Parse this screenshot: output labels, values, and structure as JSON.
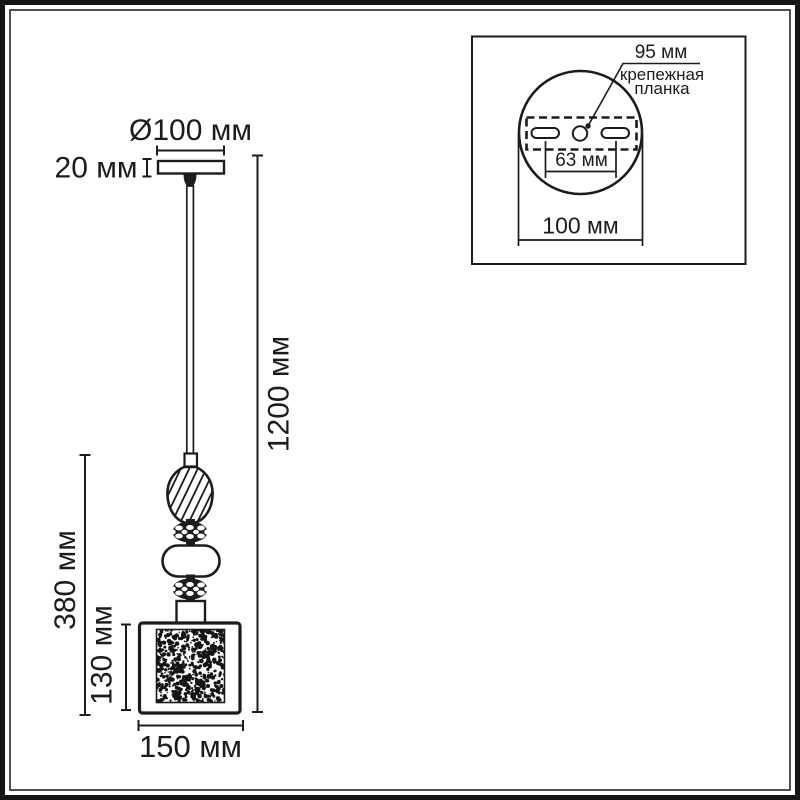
{
  "colors": {
    "line": "#1c1c1c",
    "background": "#ffffff",
    "border_outer": "#151515",
    "border_inner": "#3c3c3c"
  },
  "main_drawing": {
    "canopy_diameter": "Ø100 мм",
    "canopy_height": "20 мм",
    "suspension_height": "1200 мм",
    "body_height": "380 мм",
    "shade_height": "130 мм",
    "shade_width": "150 мм"
  },
  "inset": {
    "bracket_length": "95 мм",
    "bracket_label_line1": "крепежная",
    "bracket_label_line2": "планка",
    "hole_spacing": "63 мм",
    "plate_diameter": "100 мм"
  }
}
